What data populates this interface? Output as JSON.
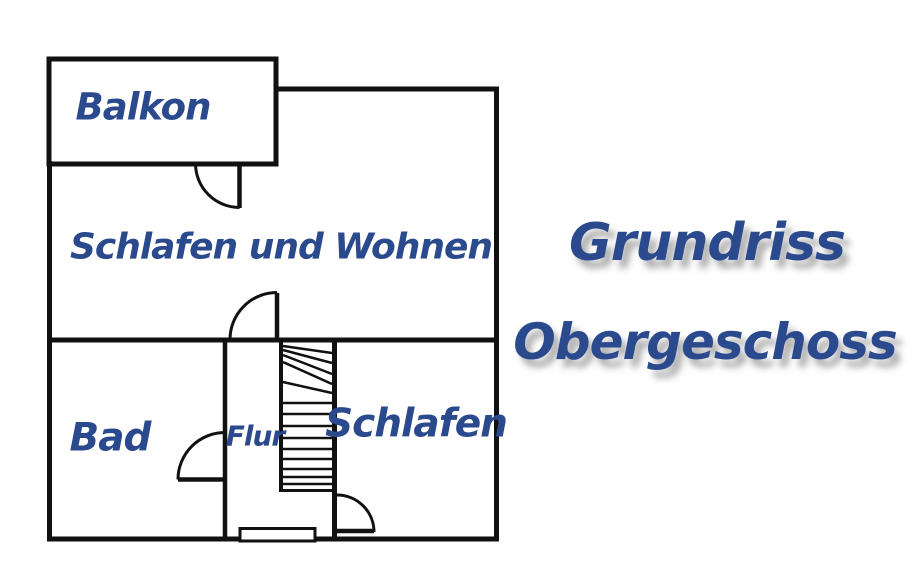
{
  "title": {
    "line1": "Grundriss",
    "line2": "Obergeschoss"
  },
  "rooms": {
    "balkon": "Balkon",
    "schlafen_wohnen": "Schlafen und Wohnen",
    "bad": "Bad",
    "flur": "Flur",
    "schlafen": "Schlafen"
  },
  "colors": {
    "label_blue": "#2b4a8e",
    "wall_black": "#111111",
    "background": "#ffffff"
  }
}
